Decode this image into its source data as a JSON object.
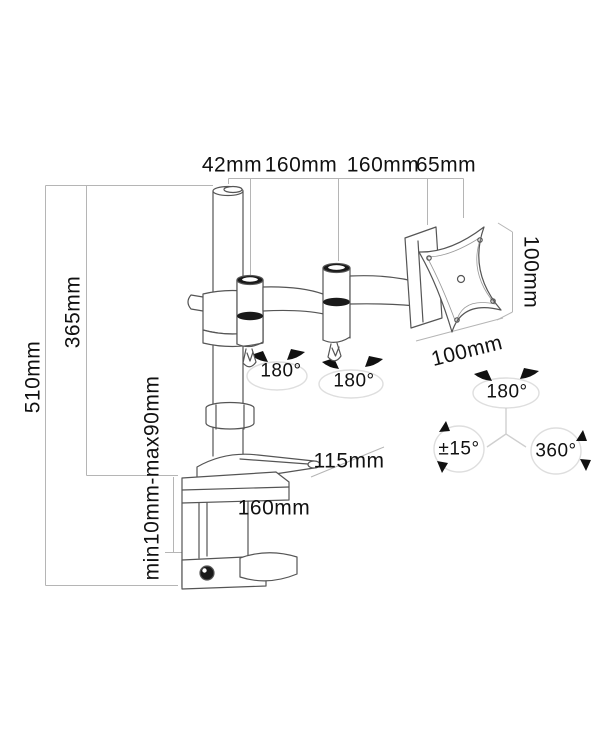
{
  "diagram": {
    "dimensions": {
      "top": [
        "42mm",
        "160mm",
        "160mm",
        "65mm"
      ],
      "total_height": "510mm",
      "pole_height": "365mm",
      "clamp_range": "min10mm-max90mm",
      "vesa_height": "100mm",
      "vesa_width": "100mm",
      "lever_length": "115mm",
      "base_depth": "160mm"
    },
    "rotations": {
      "arm_joint_1": "180°",
      "arm_joint_2": "180°",
      "head_swivel": "180°",
      "tilt": "±15°",
      "rotation": "360°"
    },
    "colors": {
      "line": "#555555",
      "dimension_line": "#b5b5b5",
      "arc": "#dedede",
      "ink": "#111111"
    }
  }
}
